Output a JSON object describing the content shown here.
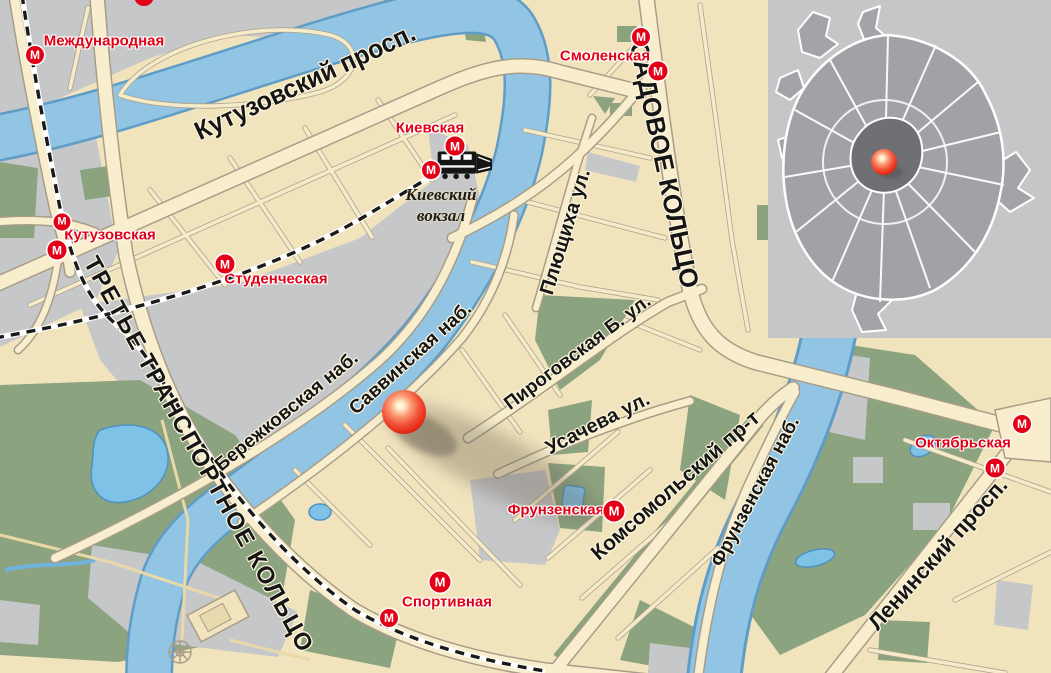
{
  "map": {
    "metro_symbol": "М",
    "stations": [
      {
        "id": "mezhdunarodnaya",
        "label": "Международная"
      },
      {
        "id": "kutuzovskaya",
        "label": "Кутузовская"
      },
      {
        "id": "studencheskaya",
        "label": "Студенческая"
      },
      {
        "id": "kievskaya",
        "label": "Киевская"
      },
      {
        "id": "smolenskaya",
        "label": "Смоленская"
      },
      {
        "id": "frunzenskaya",
        "label": "Фрунзенская"
      },
      {
        "id": "sportivnaya",
        "label": "Спортивная"
      },
      {
        "id": "oktyabrskaya",
        "label": "Октябрьская"
      }
    ],
    "streets": [
      {
        "id": "kutuzovsky",
        "label": "Кутузовский просп."
      },
      {
        "id": "sadovoe",
        "label": "САДОВОЕ КОЛЬЦО"
      },
      {
        "id": "plyushchikha",
        "label": "Плющиха ул."
      },
      {
        "id": "ttk",
        "label": "ТРЕТЬЕ ТРАНСПОРТНОЕ КОЛЬЦО"
      },
      {
        "id": "berezhkovskaya",
        "label": "Бережковская наб."
      },
      {
        "id": "savvinskaya",
        "label": "Саввинская наб."
      },
      {
        "id": "pirogovskaya",
        "label": "Пироговская Б. ул."
      },
      {
        "id": "usacheva",
        "label": "Усачева ул."
      },
      {
        "id": "komsomolsky",
        "label": "Комсомольский пр-т"
      },
      {
        "id": "frunzenskaya_nab",
        "label": "Фрунзенская наб."
      },
      {
        "id": "leninsky",
        "label": "Ленинский просп."
      }
    ],
    "places": {
      "kievsky_line1": "Киевский",
      "kievsky_line2": "вокзал"
    },
    "colors": {
      "land": "#f1e4bd",
      "water": "#92c4e4",
      "park": "#8ca37f",
      "urban_gray": "#c6c7c9",
      "road": "#f8eecd",
      "metro_red": "#e30016",
      "marker_red": "#e8321e"
    }
  }
}
